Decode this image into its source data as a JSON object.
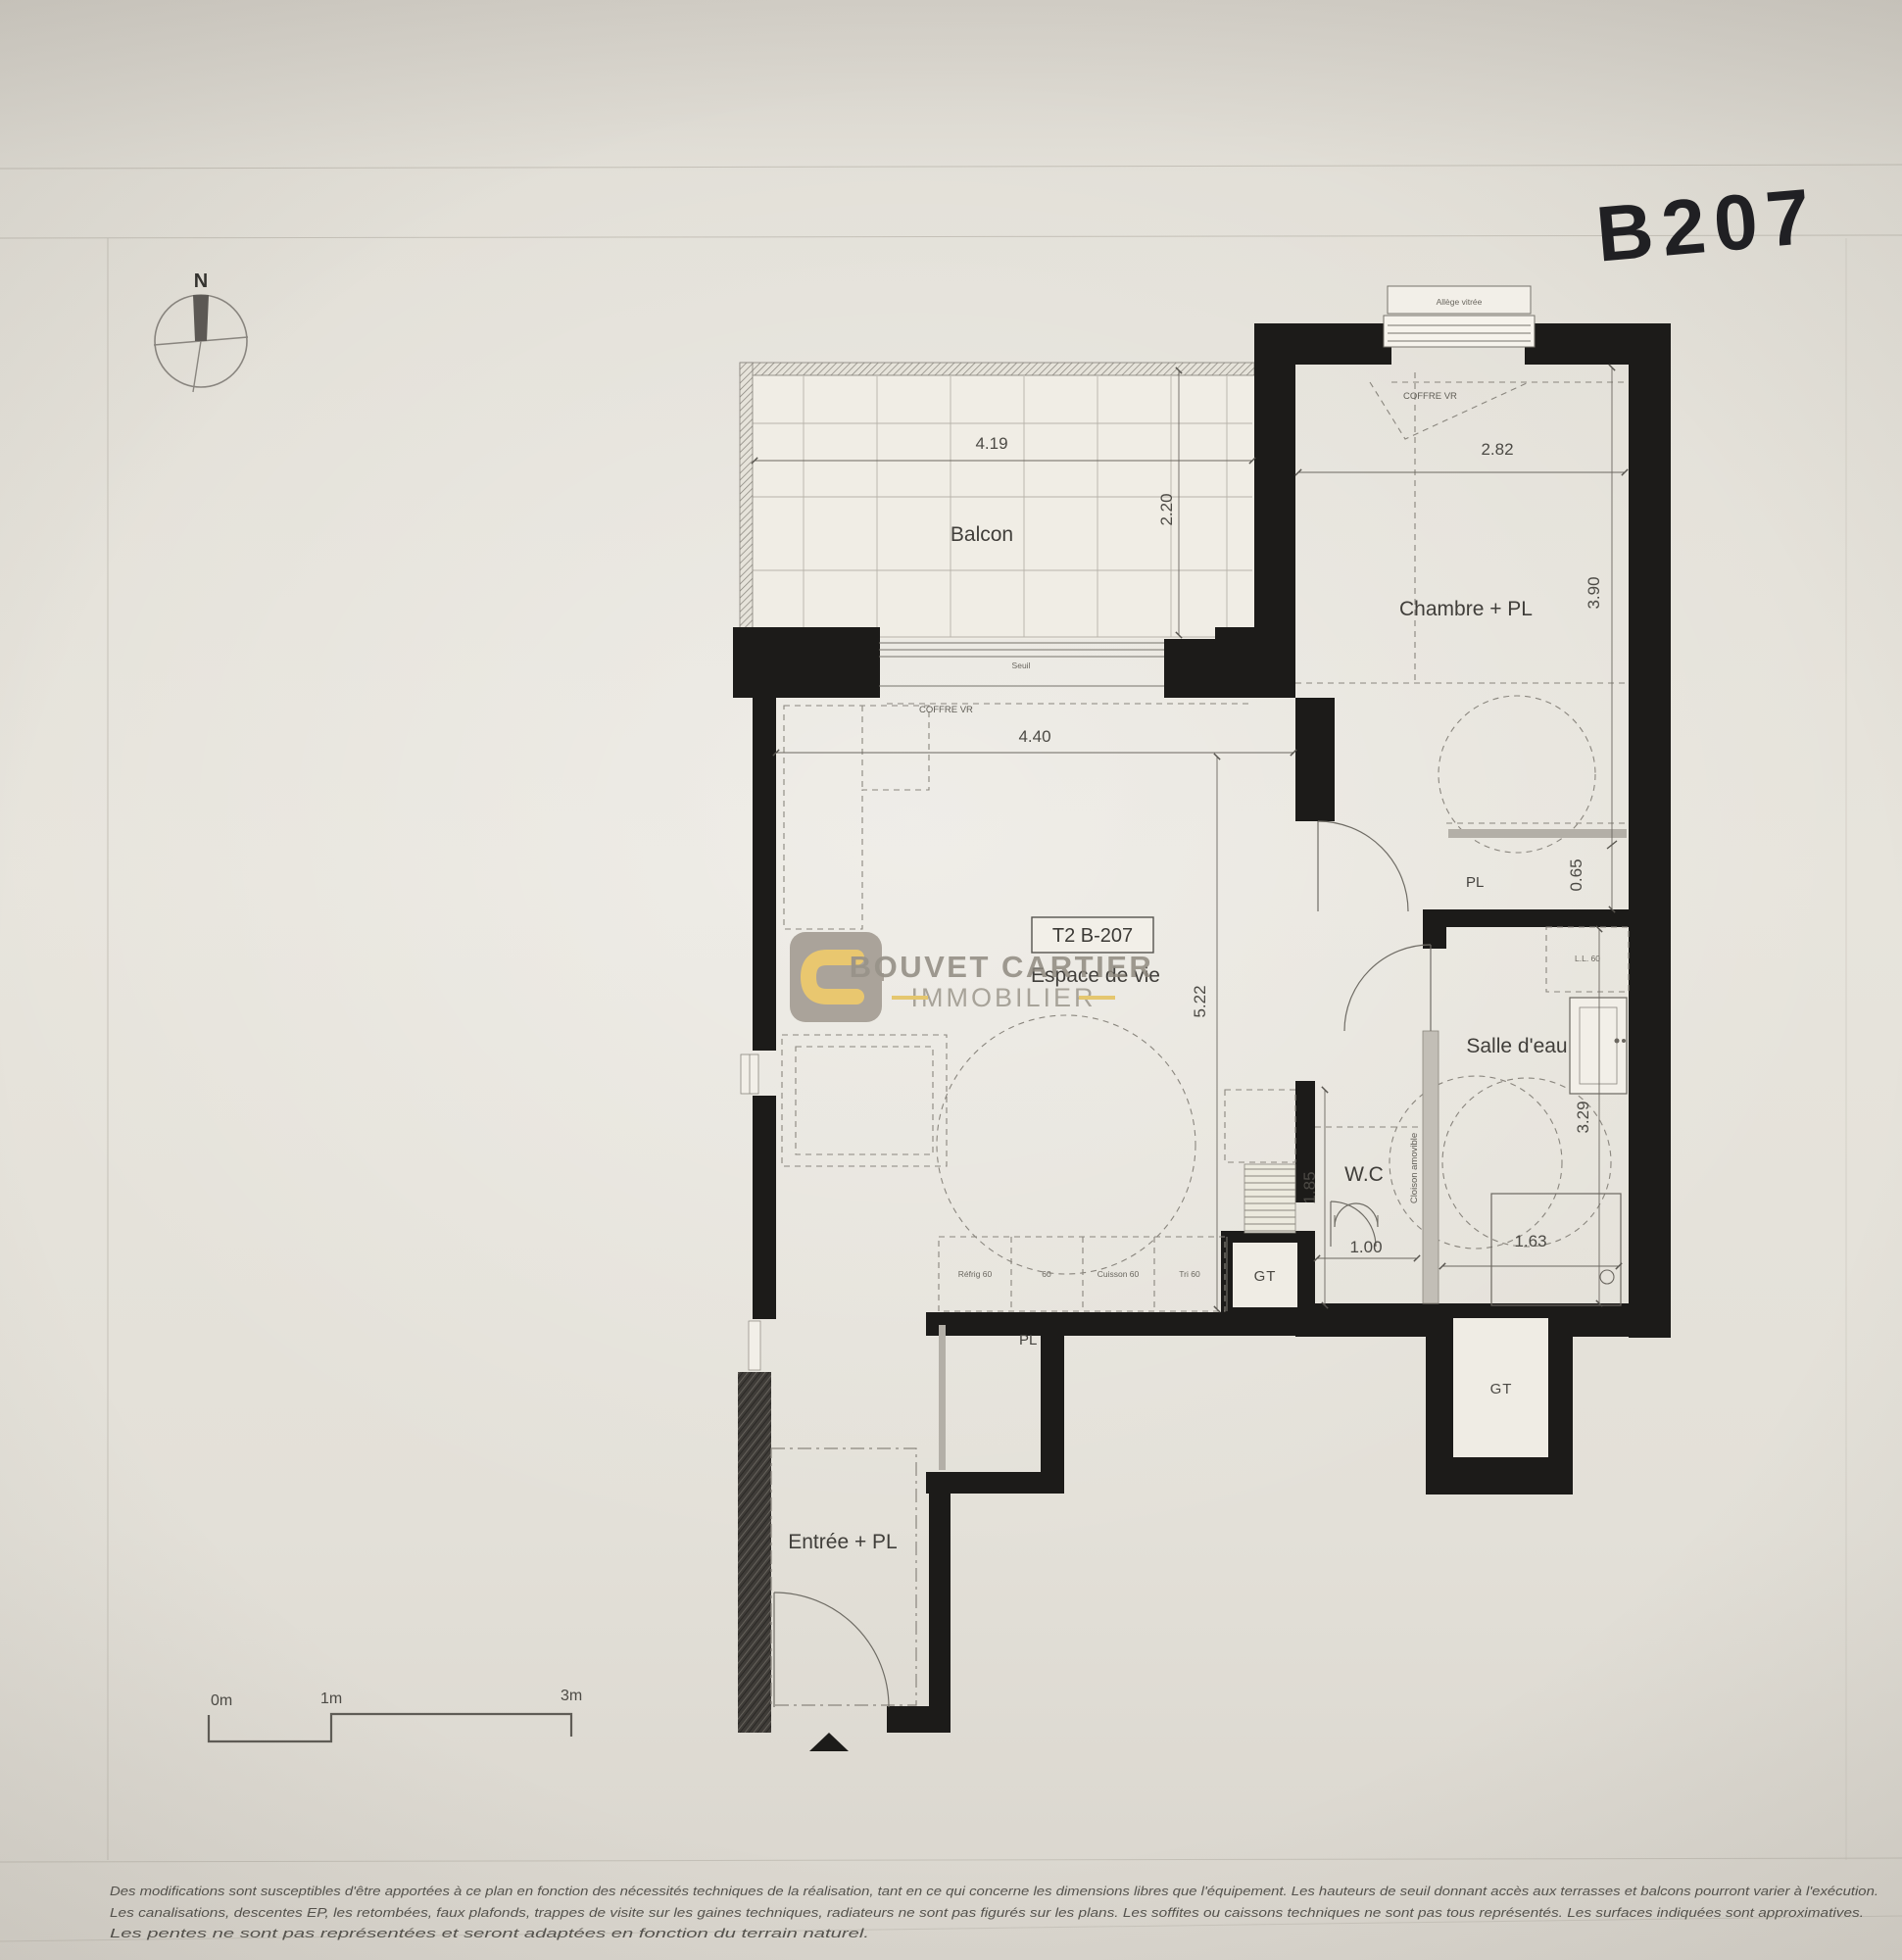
{
  "photo": {
    "handwritten_code": "B207"
  },
  "compass": {
    "north_label": "N"
  },
  "plan": {
    "unit_label": "T2 B-207",
    "rooms": {
      "balcon": "Balcon",
      "chambre": "Chambre + PL",
      "sejour": "Espace de vie",
      "salle_deau": "Salle d'eau",
      "wc": "W.C",
      "entree": "Entrée + PL",
      "pl_chambre": "PL",
      "pl_entree": "PL",
      "gt_upper": "GT",
      "gt_lower": "GT"
    },
    "dims": {
      "balcon_w": "4.19",
      "balcon_d": "2.20",
      "chambre_w": "2.82",
      "chambre_d": "3.90",
      "placard_d": "0.65",
      "sejour_w": "4.40",
      "sejour_d": "5.22",
      "wc_d": "1.85",
      "wc_w": "1.00",
      "sde_d": "3.29",
      "douche_w": "1.63"
    },
    "annot": {
      "allege": "Allège vitrée",
      "coffre_chambre": "COFFRE VR",
      "coffre_sejour": "COFFRE VR",
      "seuil": "Seuil",
      "lave_linge": "L.L. 60",
      "cloison": "Cloison amovible",
      "kitchen_units": [
        "Réfrig 60",
        "60",
        "Cuisson 60",
        "Tri 60"
      ]
    }
  },
  "watermark": {
    "brand_line1": "BOUVET CARTIER",
    "brand_line2": "IMMOBILIER"
  },
  "scalebar": {
    "zero": "0m",
    "one": "1m",
    "three": "3m"
  },
  "footer": {
    "line1": "Des modifications sont susceptibles d'être apportées à ce plan en fonction des nécessités techniques de la réalisation, tant en ce qui concerne les dimensions libres que l'équipement. Les hauteurs de seuil donnant accès aux terrasses et balcons pourront varier à l'exécution.",
    "line2": "Les canalisations, descentes EP, les retombées, faux plafonds, trappes de visite sur les gaines techniques, radiateurs ne sont pas figurés sur les plans. Les soffites ou caissons techniques ne sont pas tous représentés. Les surfaces indiquées sont approximatives.",
    "line3": "Les pentes ne sont pas représentées et seront adaptées en fonction du terrain naturel."
  }
}
